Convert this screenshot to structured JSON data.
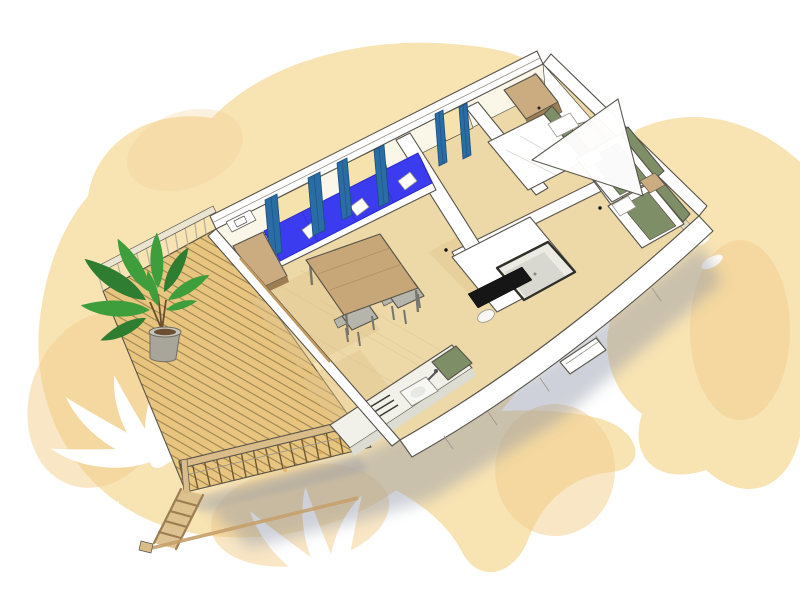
{
  "meta": {
    "title": "3D cutaway floor plan of a mobile home with wooden terrace",
    "description": "Isometric watercolor-style illustration: mobile home seen from above with roof removed, showing terrace with plant, living room with blue sofa cushions, dining table, kitchen, bathroom with shower, and two bedrooms with olive-green bedding, over peach watercolor blobs with white palm-leaf silhouettes."
  },
  "colors": {
    "paper": "#FFFFFF",
    "blob": "#F8E3B3",
    "blob_deep": "#F1CD8B",
    "blob_stain": "#DE9E45",
    "wall": "#FFFFFF",
    "wall_shade": "#DDDCD2",
    "wall_inner": "#FAF6E8",
    "window_glow": "#F6E2AC",
    "outline": "#57544A",
    "floor": "#EDD8A8",
    "floor_patch": "#E2C78E",
    "deck": "#E8C57F",
    "deck_line": "#6E5732",
    "railing": "#D9BC87",
    "railing_light": "#EBE4D0",
    "curtain": "#2A6CA4",
    "curtain_dark": "#1C4D7E",
    "cushion": "#3B3BEF",
    "olive": "#7E8F68",
    "wood": "#CBAB80",
    "wood_dark": "#9C7E52",
    "table": "#C7A678",
    "seat": "#B5B5AC",
    "plant": "#3E9E3C",
    "plant_dark": "#2E7D31",
    "pot": "#A8A69B",
    "shadow": "#8B92A4",
    "dark_panel": "#161616",
    "sink": "#F7F7F3"
  },
  "scene": {
    "background": [
      "watercolor-blob-top-left",
      "watercolor-blob-right",
      "watercolor-blob-bottom",
      "palm-silhouettes",
      "orange-stains"
    ],
    "rooms": [
      {
        "id": "terrace",
        "features": [
          "wood-plank-deck",
          "back-railing",
          "front-railing",
          "ladder-steps",
          "potted-plant"
        ]
      },
      {
        "id": "living-room",
        "features": [
          "sofa-blue-cushions",
          "throw-pillows",
          "window-curtains-blue",
          "tv-cabinet",
          "dining-table",
          "chairs"
        ]
      },
      {
        "id": "kitchen",
        "features": [
          "counter",
          "sink-with-faucet",
          "cooktop",
          "olive-tall-cabinet"
        ]
      },
      {
        "id": "bathroom",
        "features": [
          "shower-cabin",
          "dark-glass-panel",
          "washbasin"
        ]
      },
      {
        "id": "master-bedroom",
        "features": [
          "double-bed",
          "olive-headboard",
          "wood-wardrobe"
        ]
      },
      {
        "id": "twin-bedroom",
        "features": [
          "single-bed-a",
          "single-bed-b",
          "nightstand",
          "olive-blankets"
        ]
      }
    ]
  }
}
